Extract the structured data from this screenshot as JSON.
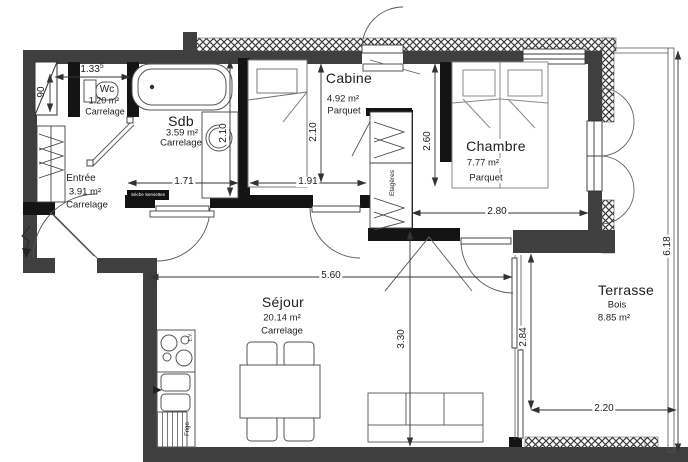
{
  "plan": {
    "rooms": {
      "wc": {
        "name": "Wc",
        "area": "1.20 m²",
        "floor": "Carrelage"
      },
      "sdb": {
        "name": "Sdb",
        "area": "3.59 m²",
        "floor": "Carrelage"
      },
      "entree": {
        "name": "Entrée",
        "area": "3.91 m²",
        "floor": "Carrelage"
      },
      "cabine": {
        "name": "Cabine",
        "area": "4.92 m²",
        "floor": "Parquet"
      },
      "chambre": {
        "name": "Chambre",
        "area": "7.77 m²",
        "floor": "Parquet"
      },
      "sejour": {
        "name": "Séjour",
        "area": "20.14 m²",
        "floor": "Carrelage"
      },
      "terrasse": {
        "name": "Terrasse",
        "area": "8.85 m²",
        "floor": "Bois"
      }
    },
    "dimensions": {
      "wc_width": {
        "value": "1.33",
        "sup": "5"
      },
      "shaft_width": "90",
      "sdb_width": "1.71",
      "sdb_depth": "2.10",
      "cabine_depth": "2.10",
      "cabine_width": "1.91",
      "closet_height": "2.60",
      "chambre_width": "2.80",
      "sejour_width": "5.60",
      "sejour_depth": "3.30",
      "terrasse_depth": "2.84",
      "terrasse_width": "2.20",
      "total_depth": "6.18"
    },
    "fixtures": {
      "towel_dryer": "Sèche Serviettes",
      "shelves": "Etagères",
      "fridge": "Frigo",
      "dishwasher": "L.V."
    },
    "colors": {
      "wall_exterior": "#3f3f3f",
      "wall_interior": "#141414",
      "line": "#3a3a3a"
    }
  }
}
